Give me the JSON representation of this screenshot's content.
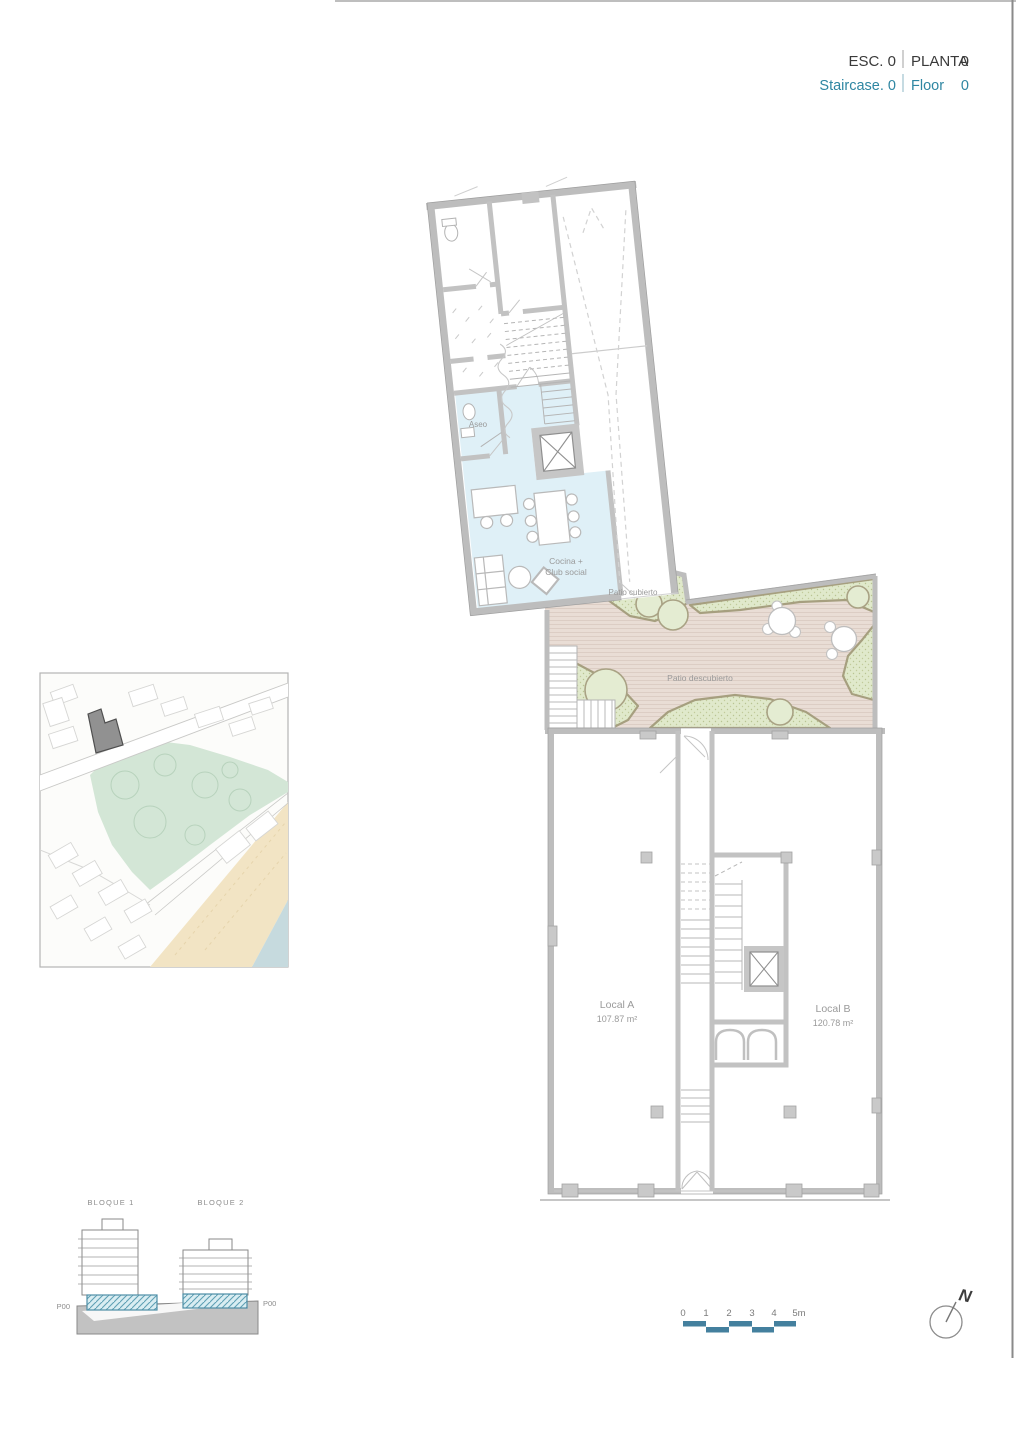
{
  "header": {
    "esc": "ESC. 0",
    "planta": "PLANTA",
    "planta_value": "0",
    "staircase": "Staircase. 0",
    "floor": "Floor",
    "floor_value": "0"
  },
  "plan": {
    "labels": {
      "aseo": "Aseo",
      "cocina_line1": "Cocina +",
      "cocina_line2": "Club social",
      "patio_cubierto": "Patio cubierto",
      "patio_descubierto": "Patio descubierto",
      "local_a": "Local A",
      "local_a_area": "107.87 m²",
      "local_b": "Local B",
      "local_b_area": "120.78 m²"
    }
  },
  "section": {
    "bloque1": "BLOQUE 1",
    "bloque2": "BLOQUE 2",
    "p00_left": "P00",
    "p00_right": "P00"
  },
  "scale_bar": {
    "labels": [
      "0",
      "1",
      "2",
      "3",
      "4",
      "5m"
    ],
    "color": "#44809e"
  },
  "compass": {
    "north": "N"
  },
  "colors": {
    "accent_teal": "#2e86a2",
    "title_dark": "#3a3a3a",
    "wall_gray": "#bdbdbd",
    "club_room_blue": "#dff0f7",
    "deck_tan": "#e9ddd5",
    "green_fill": "#e0e9cb",
    "olive_edge": "#a69f7f",
    "slab_hatch": "#5fa0b4",
    "map_park": "#d3e6d6",
    "map_sand": "#f2e4c4",
    "map_sea": "#c6dade",
    "marker_gray": "#919191"
  }
}
